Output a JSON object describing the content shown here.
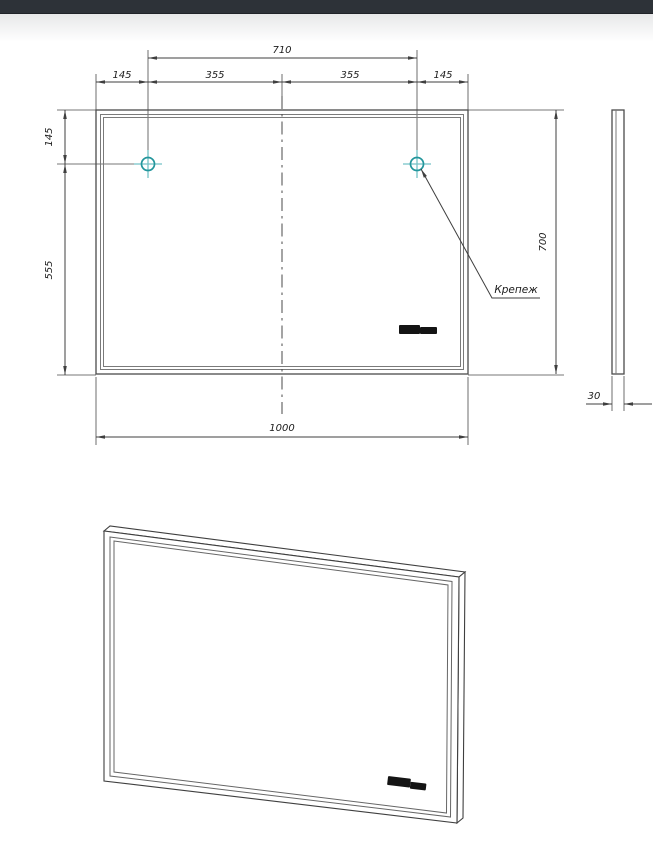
{
  "drawing": {
    "dims": {
      "top_total": "710",
      "top_segments": [
        "145",
        "355",
        "355",
        "145"
      ],
      "left_upper": "145",
      "left_lower": "555",
      "height_right": "700",
      "width_bottom": "1000",
      "depth_side": "30"
    },
    "labels": {
      "mount": "Крепеж"
    },
    "icons": {
      "mount_marker": "crosshair-circle-icon",
      "brand_logo": "brand-logo-mark"
    },
    "colors": {
      "top_bar": "#2d3238",
      "line": "#3f3f3f",
      "mount_marker_circle": "#23969c",
      "mount_marker_cross": "#74c2c6"
    }
  }
}
